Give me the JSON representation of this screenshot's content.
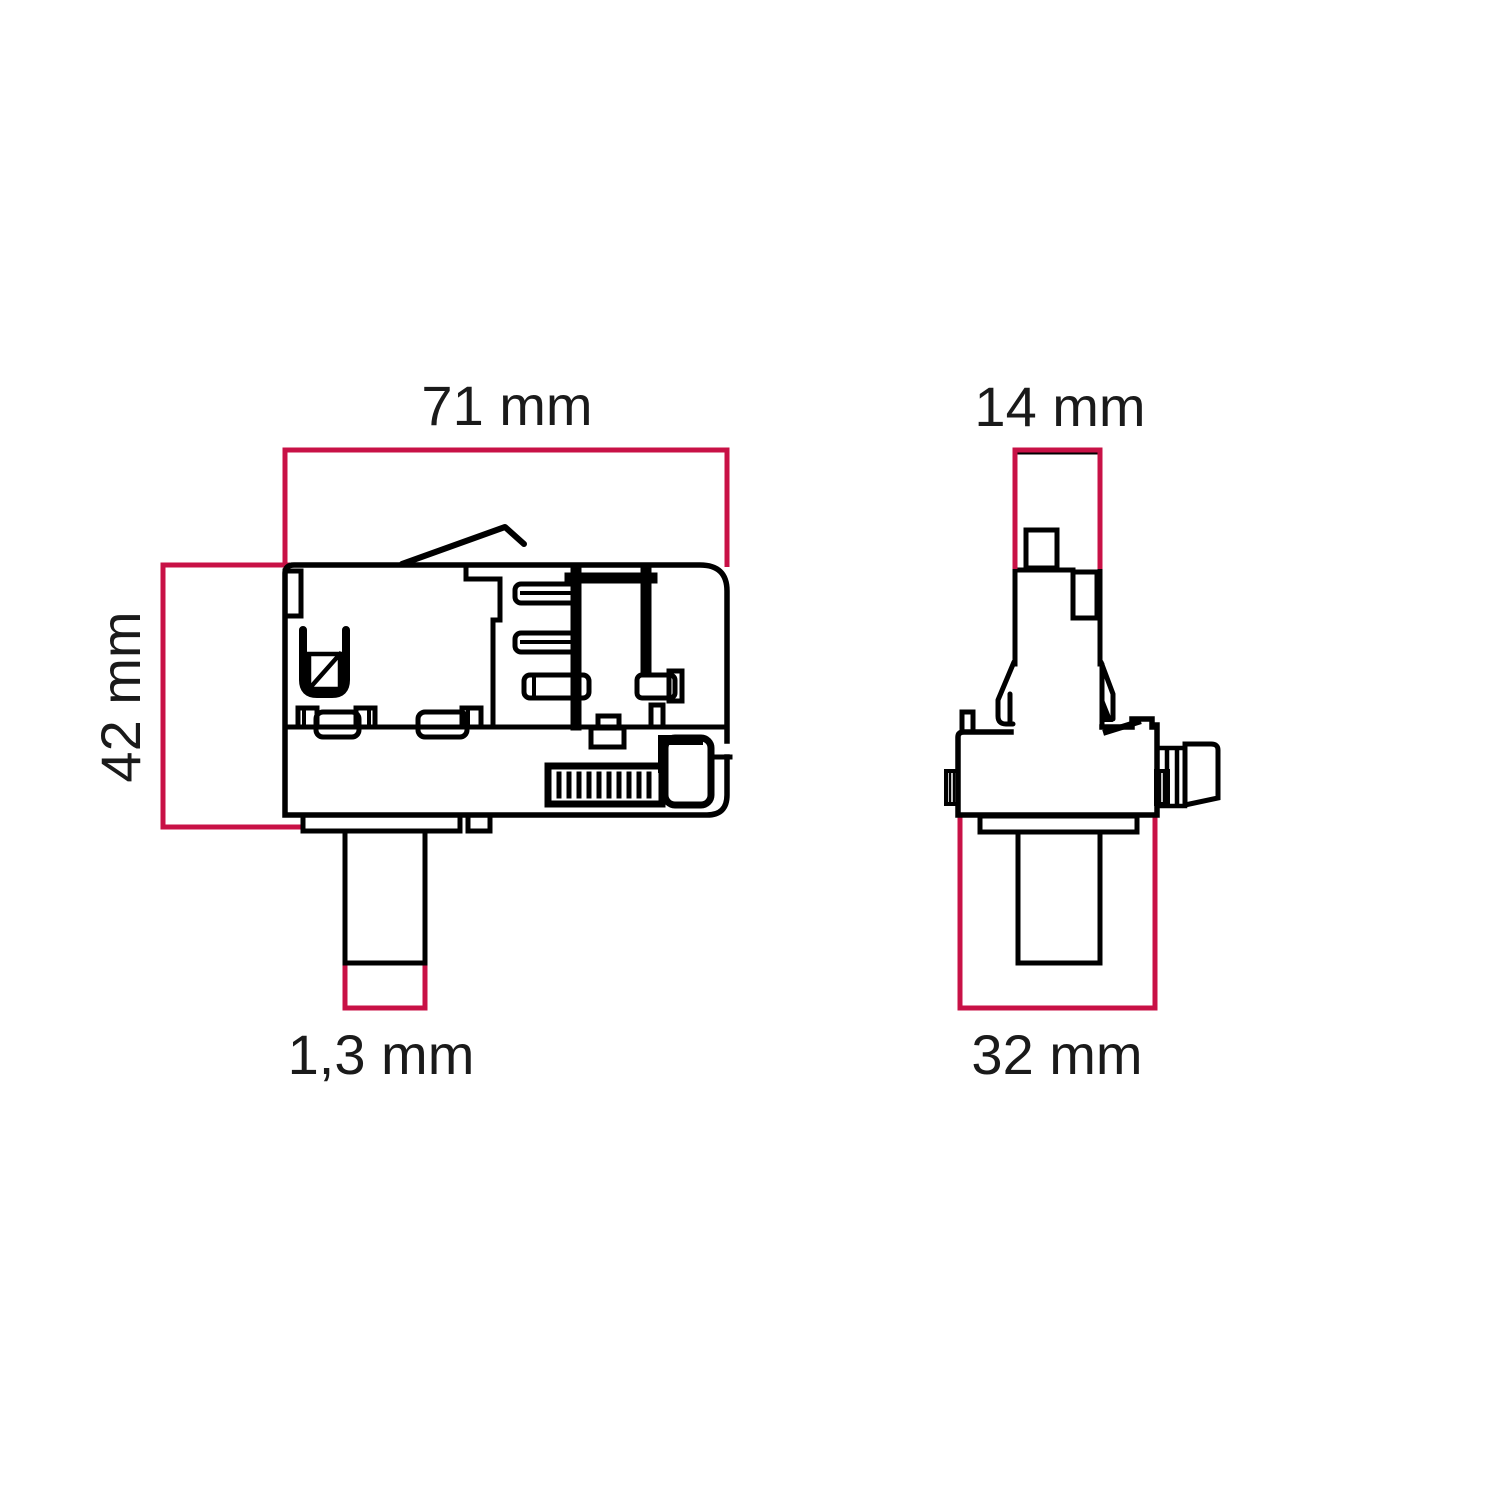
{
  "diagram": {
    "kind": "technical dimension drawing",
    "subject": "track adapter, two orthographic views"
  },
  "colors": {
    "dimension_line": "#C81146",
    "drawing_line": "#000000",
    "label_text": "#1A1A1A",
    "background": "#FFFFFF"
  },
  "views": {
    "side": {
      "name": "side view",
      "width_label": "71 mm",
      "height_label": "42 mm",
      "stem_label": "1,3 mm"
    },
    "front": {
      "name": "front view",
      "width_label": "14 mm",
      "base_label": "32 mm"
    }
  }
}
